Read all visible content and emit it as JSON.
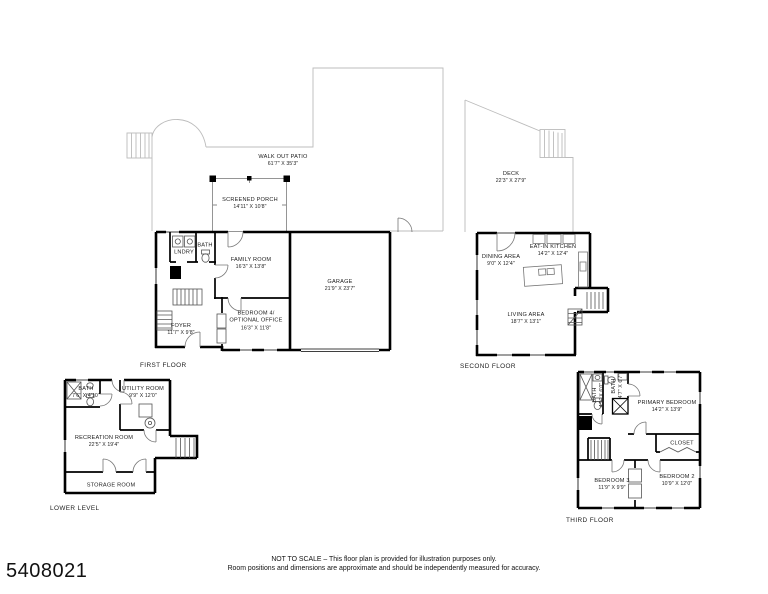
{
  "floors": {
    "first": {
      "title": "FIRST FLOOR",
      "patio": {
        "name": "WALK OUT PATIO",
        "dims": "61'7\" X 35'3\""
      },
      "screened_porch": {
        "name": "SCREENED PORCH",
        "dims": "14'11\" X 10'8\""
      },
      "lndry": {
        "name": "LNDRY"
      },
      "bath": {
        "name": "BATH"
      },
      "family_room": {
        "name": "FAMILY ROOM",
        "dims": "16'3\" X 13'8\""
      },
      "garage": {
        "name": "GARAGE",
        "dims": "21'9\" X 23'7\""
      },
      "bedroom4": {
        "name": "BEDROOM 4/",
        "name2": "OPTIONAL OFFICE",
        "dims": "16'3\" X 11'8\""
      },
      "foyer": {
        "name": "FOYER",
        "dims": "11'7\" X 9'8\""
      }
    },
    "second": {
      "title": "SECOND FLOOR",
      "deck": {
        "name": "DECK",
        "dims": "22'3\" X 27'9\""
      },
      "eat_in_kitchen": {
        "name": "EAT-IN KITCHEN",
        "dims": "14'2\" X 12'4\""
      },
      "dining_area": {
        "name": "DINING AREA",
        "dims": "9'0\" X 12'4\""
      },
      "living_area": {
        "name": "LIVING AREA",
        "dims": "18'7\" X 13'1\""
      }
    },
    "lower": {
      "title": "LOWER LEVEL",
      "bath": {
        "name": "BATH",
        "dims": "7'6\" X 4'10\""
      },
      "utility_room": {
        "name": "UTILITY ROOM",
        "dims": "9'9\" X 12'0\""
      },
      "recreation_room": {
        "name": "RECREATION ROOM",
        "dims": "22'5\" X 19'4\""
      },
      "storage_room": {
        "name": "STORAGE ROOM"
      }
    },
    "third": {
      "title": "THIRD FLOOR",
      "bath1": {
        "name": "BATH",
        "dims": "4'9\" X 6'0\""
      },
      "bath2": {
        "name": "BATH",
        "dims": "4'7\" X 6'7\""
      },
      "primary_bedroom": {
        "name": "PRIMARY BEDROOM",
        "dims": "14'2\" X 13'9\""
      },
      "closet": {
        "name": "CLOSET"
      },
      "bedroom3": {
        "name": "BEDROOM 3",
        "dims": "11'9\" X 9'9\""
      },
      "bedroom2": {
        "name": "BEDROOM 2",
        "dims": "10'9\" X 12'0\""
      }
    }
  },
  "footer": {
    "mls_number": "5408021",
    "disclaimer_line1": "NOT TO SCALE – This floor plan is provided for illustration purposes only.",
    "disclaimer_line2": "Room positions and dimensions are approximate and should be independently measured for accuracy."
  }
}
